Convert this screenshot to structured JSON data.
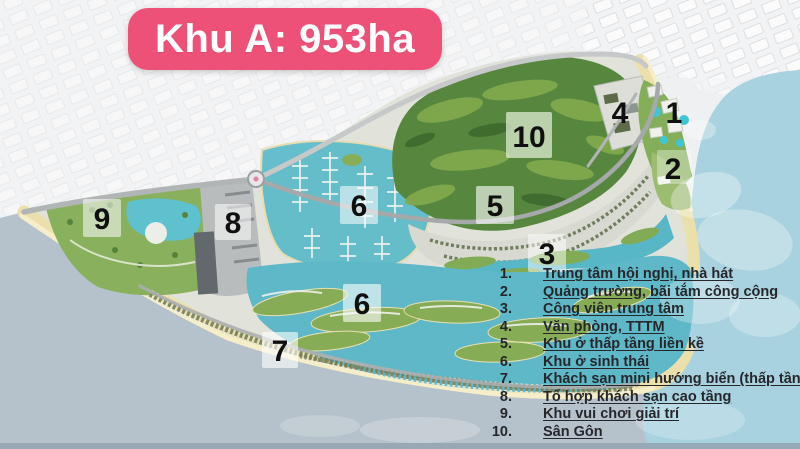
{
  "title": {
    "text": "Khu A: 953ha"
  },
  "legend": {
    "items": [
      {
        "num": "1.",
        "label": "Trung tâm hội nghị, nhà hát"
      },
      {
        "num": "2.",
        "label": "Quảng trường, bãi tắm công cộng"
      },
      {
        "num": "3.",
        "label": "Công viên trung tâm"
      },
      {
        "num": "4.",
        "label": "Văn phòng, TTTM"
      },
      {
        "num": "5.",
        "label": "Khu ở thấp tầng liền kề"
      },
      {
        "num": "6.",
        "label": "Khu ở sinh thái"
      },
      {
        "num": "7.",
        "label": "Khách sạn mini hướng biển (thấp tầng)"
      },
      {
        "num": "8.",
        "label": "Tổ hợp khách sạn cao tầng"
      },
      {
        "num": "9.",
        "label": "Khu vui chơi giải trí"
      },
      {
        "num": "10.",
        "label": "Sân Gôn"
      }
    ]
  },
  "map": {
    "markers": [
      {
        "label": "1"
      },
      {
        "label": "2"
      },
      {
        "label": "3"
      },
      {
        "label": "4"
      },
      {
        "label": "5"
      },
      {
        "label": "6"
      },
      {
        "label": "6"
      },
      {
        "label": "7"
      },
      {
        "label": "8"
      },
      {
        "label": "9"
      },
      {
        "label": "10"
      }
    ]
  },
  "colors": {
    "banner": "#ee5178",
    "banner_text": "#ffffff",
    "sea_left": "#b6c2cb",
    "sea_right": "#a8d2df",
    "lagoon_water": "#5eb8c8",
    "golf_green": "#57873f",
    "park_green": "#88b05d",
    "beach_sand": "#ebdfac",
    "legend_text": "#26262b",
    "marker_text": "#101010"
  }
}
